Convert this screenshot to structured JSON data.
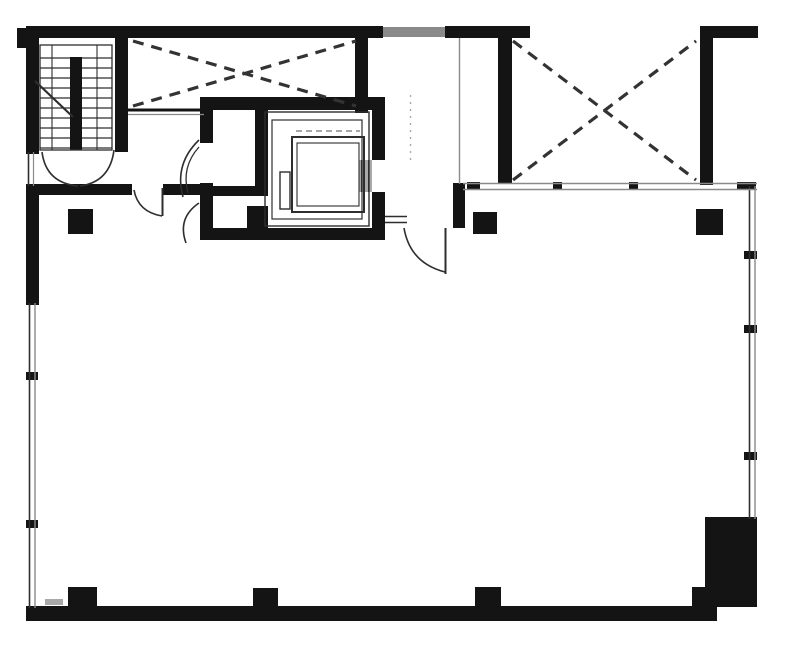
{
  "meta": {
    "description": "Black-and-white architectural floor plan: stairwell top-left, two X-braced shaft bays, central elevator core with cab, open floor area with columns, thin double-line window walls on left and right, heavy corner pier bottom-right"
  },
  "canvas": {
    "w": 787,
    "h": 649,
    "bg": "#ffffff"
  },
  "colors": {
    "wall": "#141414",
    "thin": "#2e2e2e",
    "brace": "#333333",
    "gray": "#8a8a8a",
    "light": "#a9a9a9"
  },
  "plan": {
    "shapes": [
      {
        "kind": "rect",
        "name": "top-wall-left",
        "x": 26,
        "y": 26,
        "w": 357,
        "h": 12,
        "fill": "wall"
      },
      {
        "kind": "rect",
        "name": "top-wall-hatched-segment",
        "x": 383,
        "y": 27,
        "w": 62,
        "h": 10,
        "fill": "gray"
      },
      {
        "kind": "rect",
        "name": "top-wall-right",
        "x": 445,
        "y": 26,
        "w": 85,
        "h": 12,
        "fill": "wall"
      },
      {
        "kind": "rect",
        "name": "top-right-cap-wall",
        "x": 700,
        "y": 26,
        "w": 58,
        "h": 12,
        "fill": "wall"
      },
      {
        "kind": "rect",
        "name": "top-right-side-wall",
        "x": 700,
        "y": 26,
        "w": 13,
        "h": 159,
        "fill": "wall"
      },
      {
        "kind": "rect",
        "name": "right-shaft-left-wall",
        "x": 498,
        "y": 26,
        "w": 14,
        "h": 158,
        "fill": "wall"
      },
      {
        "kind": "rect",
        "name": "stair-left-wall",
        "x": 26,
        "y": 26,
        "w": 13,
        "h": 128,
        "fill": "wall"
      },
      {
        "kind": "rect",
        "name": "top-left-corner-nub",
        "x": 17,
        "y": 28,
        "w": 10,
        "h": 20,
        "fill": "wall"
      },
      {
        "kind": "rect",
        "name": "stair-right-wall",
        "x": 115,
        "y": 26,
        "w": 13,
        "h": 126,
        "fill": "wall"
      },
      {
        "kind": "rect",
        "name": "left-wall-mid",
        "x": 26,
        "y": 184,
        "w": 13,
        "h": 121,
        "fill": "wall"
      },
      {
        "kind": "rect",
        "name": "under-stair-wall",
        "x": 26,
        "y": 184,
        "w": 106,
        "h": 11,
        "fill": "wall"
      },
      {
        "kind": "rect",
        "name": "lobby-wall",
        "x": 163,
        "y": 184,
        "w": 37,
        "h": 11,
        "fill": "wall"
      },
      {
        "kind": "rect",
        "name": "brace-bay-right-wall",
        "x": 355,
        "y": 38,
        "w": 13,
        "h": 75,
        "fill": "wall"
      },
      {
        "kind": "rect",
        "name": "core-top-wall",
        "x": 200,
        "y": 97,
        "w": 185,
        "h": 13,
        "fill": "wall"
      },
      {
        "kind": "rect",
        "name": "core-left-wall-upper",
        "x": 200,
        "y": 97,
        "w": 13,
        "h": 46,
        "fill": "wall"
      },
      {
        "kind": "rect",
        "name": "core-left-wall-lower",
        "x": 200,
        "y": 183,
        "w": 13,
        "h": 57,
        "fill": "wall"
      },
      {
        "kind": "rect",
        "name": "core-right-wall-upper",
        "x": 372,
        "y": 97,
        "w": 13,
        "h": 63,
        "fill": "wall"
      },
      {
        "kind": "rect",
        "name": "core-right-wall-lower",
        "x": 372,
        "y": 192,
        "w": 13,
        "h": 48,
        "fill": "wall"
      },
      {
        "kind": "rect",
        "name": "core-bottom-wall",
        "x": 200,
        "y": 228,
        "w": 185,
        "h": 12,
        "fill": "wall"
      },
      {
        "kind": "rect",
        "name": "core-divider-wall",
        "x": 255,
        "y": 110,
        "w": 13,
        "h": 85,
        "fill": "wall"
      },
      {
        "kind": "rect",
        "name": "core-room-wall",
        "x": 200,
        "y": 186,
        "w": 68,
        "h": 10,
        "fill": "wall"
      },
      {
        "kind": "rect",
        "name": "duct-block",
        "x": 247,
        "y": 206,
        "w": 21,
        "h": 24,
        "fill": "wall"
      },
      {
        "kind": "rect",
        "name": "lobby-stub-wall",
        "x": 453,
        "y": 183,
        "w": 12,
        "h": 45,
        "fill": "wall"
      },
      {
        "kind": "rect",
        "name": "bottom-wall",
        "x": 26,
        "y": 606,
        "w": 691,
        "h": 15,
        "fill": "wall"
      },
      {
        "kind": "rect",
        "name": "corner-pier",
        "x": 705,
        "y": 517,
        "w": 52,
        "h": 90,
        "fill": "wall"
      },
      {
        "kind": "rect",
        "name": "corner-pier-step",
        "x": 692,
        "y": 587,
        "w": 16,
        "h": 33,
        "fill": "wall"
      },
      {
        "kind": "rect",
        "name": "stair-divider-wall",
        "x": 70,
        "y": 57,
        "w": 12,
        "h": 93,
        "fill": "wall"
      },
      {
        "kind": "rect",
        "name": "column-top-left",
        "x": 68,
        "y": 209,
        "w": 25,
        "h": 25,
        "fill": "wall"
      },
      {
        "kind": "rect",
        "name": "column-top-center",
        "x": 473,
        "y": 212,
        "w": 24,
        "h": 22,
        "fill": "wall"
      },
      {
        "kind": "rect",
        "name": "column-top-right",
        "x": 696,
        "y": 209,
        "w": 27,
        "h": 26,
        "fill": "wall"
      },
      {
        "kind": "rect",
        "name": "column-bottom-left",
        "x": 68,
        "y": 587,
        "w": 29,
        "h": 25,
        "fill": "wall"
      },
      {
        "kind": "rect",
        "name": "column-bottom-center-left",
        "x": 253,
        "y": 588,
        "w": 25,
        "h": 25,
        "fill": "wall"
      },
      {
        "kind": "rect",
        "name": "column-bottom-center-right",
        "x": 475,
        "y": 587,
        "w": 26,
        "h": 25,
        "fill": "wall"
      },
      {
        "kind": "rect",
        "name": "spandrel-tick-1",
        "x": 467,
        "y": 182,
        "w": 13,
        "h": 8,
        "fill": "wall"
      },
      {
        "kind": "rect",
        "name": "spandrel-tick-2",
        "x": 553,
        "y": 182,
        "w": 9,
        "h": 8,
        "fill": "wall"
      },
      {
        "kind": "rect",
        "name": "spandrel-tick-3",
        "x": 629,
        "y": 182,
        "w": 9,
        "h": 8,
        "fill": "wall"
      },
      {
        "kind": "rect",
        "name": "spandrel-tick-4",
        "x": 737,
        "y": 182,
        "w": 19,
        "h": 8,
        "fill": "wall"
      },
      {
        "kind": "rect",
        "name": "left-window-mullion-1",
        "x": 26,
        "y": 372,
        "w": 12,
        "h": 8,
        "fill": "wall"
      },
      {
        "kind": "rect",
        "name": "left-window-mullion-2",
        "x": 26,
        "y": 520,
        "w": 12,
        "h": 8,
        "fill": "wall"
      },
      {
        "kind": "rect",
        "name": "right-window-mullion-1",
        "x": 744,
        "y": 251,
        "w": 13,
        "h": 8,
        "fill": "wall"
      },
      {
        "kind": "rect",
        "name": "right-window-mullion-2",
        "x": 744,
        "y": 325,
        "w": 13,
        "h": 8,
        "fill": "wall"
      },
      {
        "kind": "rect",
        "name": "right-window-mullion-3",
        "x": 744,
        "y": 452,
        "w": 13,
        "h": 8,
        "fill": "wall"
      },
      {
        "kind": "rect",
        "name": "corner-sill-dash",
        "x": 45,
        "y": 599,
        "w": 18,
        "h": 6,
        "fill": "light"
      },
      {
        "kind": "rect",
        "name": "elevator-door-panel",
        "x": 359,
        "y": 160,
        "w": 13,
        "h": 32,
        "fill": "light"
      },
      {
        "kind": "rect",
        "name": "elevator-shaft-lining-outer",
        "x": 265,
        "y": 112,
        "w": 104,
        "h": 114,
        "stroke": "thin",
        "sw": 1.4
      },
      {
        "kind": "rect",
        "name": "elevator-shaft-lining-inner",
        "x": 272,
        "y": 120,
        "w": 90,
        "h": 99,
        "stroke": "thin",
        "sw": 1.2
      },
      {
        "kind": "rect",
        "name": "elevator-cab-outer",
        "x": 292,
        "y": 137,
        "w": 72,
        "h": 75,
        "stroke": "thin",
        "sw": 2
      },
      {
        "kind": "rect",
        "name": "elevator-cab-inner",
        "x": 297,
        "y": 143,
        "w": 62,
        "h": 63,
        "stroke": "thin",
        "sw": 1.1
      },
      {
        "kind": "rect",
        "name": "elevator-counterweight",
        "x": 280,
        "y": 172,
        "w": 10,
        "h": 37,
        "stroke": "thin",
        "sw": 1.4
      },
      {
        "kind": "rect",
        "name": "stair-well-frame",
        "x": 40,
        "y": 45,
        "w": 72,
        "h": 105,
        "stroke": "thin",
        "sw": 1.3
      },
      {
        "kind": "line",
        "name": "left-window-line-outer",
        "x1": 29.5,
        "y1": 303,
        "x2": 29.5,
        "y2": 608,
        "stroke": "thin",
        "sw": 1.6
      },
      {
        "kind": "line",
        "name": "left-window-line-inner",
        "x1": 35,
        "y1": 303,
        "x2": 35,
        "y2": 608,
        "stroke": "gray",
        "sw": 1.4
      },
      {
        "kind": "line",
        "name": "stair-window-line-outer",
        "x1": 28.5,
        "y1": 152,
        "x2": 28.5,
        "y2": 186,
        "stroke": "thin",
        "sw": 1.6
      },
      {
        "kind": "line",
        "name": "stair-window-line-inner",
        "x1": 33.5,
        "y1": 152,
        "x2": 33.5,
        "y2": 186,
        "stroke": "gray",
        "sw": 1.2
      },
      {
        "kind": "line",
        "name": "right-window-line-outer",
        "x1": 749.5,
        "y1": 186,
        "x2": 749.5,
        "y2": 519,
        "stroke": "thin",
        "sw": 1.6
      },
      {
        "kind": "line",
        "name": "right-window-line-inner",
        "x1": 755,
        "y1": 186,
        "x2": 755,
        "y2": 519,
        "stroke": "gray",
        "sw": 1.4
      },
      {
        "kind": "line",
        "name": "front-spandrel-line-top",
        "x1": 463,
        "y1": 183.5,
        "x2": 757,
        "y2": 183.5,
        "stroke": "gray",
        "sw": 1.6
      },
      {
        "kind": "line",
        "name": "front-spandrel-line-bottom",
        "x1": 463,
        "y1": 189.5,
        "x2": 757,
        "y2": 189.5,
        "stroke": "gray",
        "sw": 1.6
      },
      {
        "kind": "line",
        "name": "brace-bay-chord",
        "x1": 128,
        "y1": 110,
        "x2": 204,
        "y2": 110,
        "stroke": "wall",
        "sw": 3
      },
      {
        "kind": "line",
        "name": "brace-bay-chord-shadow",
        "x1": 128,
        "y1": 114.5,
        "x2": 204,
        "y2": 114.5,
        "stroke": "gray",
        "sw": 1.2
      },
      {
        "kind": "line",
        "name": "corridor-partition-line",
        "x1": 459.5,
        "y1": 38,
        "x2": 459.5,
        "y2": 184,
        "stroke": "gray",
        "sw": 1.4
      },
      {
        "kind": "line",
        "name": "layout-dotted-line",
        "x1": 410.5,
        "y1": 95,
        "x2": 410.5,
        "y2": 165,
        "stroke": "light",
        "sw": 1.4,
        "dash": "2 5"
      },
      {
        "kind": "line",
        "name": "core-room-finish-line-top",
        "x1": 385,
        "y1": 216.5,
        "x2": 407,
        "y2": 216.5,
        "stroke": "thin",
        "sw": 1.6
      },
      {
        "kind": "line",
        "name": "core-room-finish-line-bottom",
        "x1": 385,
        "y1": 222.5,
        "x2": 407,
        "y2": 222.5,
        "stroke": "thin",
        "sw": 1.6
      },
      {
        "kind": "line",
        "name": "room-door-leaf",
        "x1": 445.5,
        "y1": 228,
        "x2": 445.5,
        "y2": 274,
        "stroke": "thin",
        "sw": 2
      },
      {
        "kind": "line",
        "name": "lobby-door-leaf",
        "x1": 162.5,
        "y1": 188,
        "x2": 162.5,
        "y2": 216,
        "stroke": "thin",
        "sw": 2
      },
      {
        "kind": "line",
        "name": "elevator-door-track-1",
        "x1": 361.5,
        "y1": 160,
        "x2": 361.5,
        "y2": 192,
        "stroke": "thin",
        "sw": 1
      },
      {
        "kind": "line",
        "name": "elevator-door-track-2",
        "x1": 368.5,
        "y1": 160,
        "x2": 368.5,
        "y2": 192,
        "stroke": "thin",
        "sw": 1
      },
      {
        "kind": "line",
        "name": "cab-hatch-line",
        "x1": 296,
        "y1": 131,
        "x2": 360,
        "y2": 131,
        "stroke": "gray",
        "sw": 1.4,
        "dash": "6 4"
      },
      {
        "kind": "line",
        "name": "stair-rail-line-left",
        "x1": 52,
        "y1": 45,
        "x2": 52,
        "y2": 150,
        "stroke": "thin",
        "sw": 1.1
      },
      {
        "kind": "line",
        "name": "stair-rail-line-right",
        "x1": 97,
        "y1": 45,
        "x2": 97,
        "y2": 150,
        "stroke": "thin",
        "sw": 1.1
      },
      {
        "kind": "line",
        "name": "stair-direction-line",
        "x1": 35,
        "y1": 81,
        "x2": 73,
        "y2": 117,
        "stroke": "thin",
        "sw": 2.2
      },
      {
        "kind": "line",
        "name": "stair-tread",
        "x1": 40,
        "y1": 58,
        "x2": 70,
        "y2": 58,
        "stroke": "thin",
        "sw": 1.3
      },
      {
        "kind": "line",
        "name": "stair-tread",
        "x1": 40,
        "y1": 68,
        "x2": 70,
        "y2": 68,
        "stroke": "thin",
        "sw": 1.3
      },
      {
        "kind": "line",
        "name": "stair-tread",
        "x1": 40,
        "y1": 78,
        "x2": 70,
        "y2": 78,
        "stroke": "thin",
        "sw": 1.3
      },
      {
        "kind": "line",
        "name": "stair-tread",
        "x1": 40,
        "y1": 88,
        "x2": 70,
        "y2": 88,
        "stroke": "thin",
        "sw": 1.3
      },
      {
        "kind": "line",
        "name": "stair-tread",
        "x1": 40,
        "y1": 98,
        "x2": 70,
        "y2": 98,
        "stroke": "thin",
        "sw": 1.3
      },
      {
        "kind": "line",
        "name": "stair-tread",
        "x1": 40,
        "y1": 108,
        "x2": 70,
        "y2": 108,
        "stroke": "thin",
        "sw": 1.3
      },
      {
        "kind": "line",
        "name": "stair-tread",
        "x1": 40,
        "y1": 118,
        "x2": 70,
        "y2": 118,
        "stroke": "thin",
        "sw": 1.3
      },
      {
        "kind": "line",
        "name": "stair-tread",
        "x1": 40,
        "y1": 128,
        "x2": 70,
        "y2": 128,
        "stroke": "thin",
        "sw": 1.3
      },
      {
        "kind": "line",
        "name": "stair-tread",
        "x1": 40,
        "y1": 138,
        "x2": 70,
        "y2": 138,
        "stroke": "thin",
        "sw": 1.3
      },
      {
        "kind": "line",
        "name": "stair-tread",
        "x1": 40,
        "y1": 148,
        "x2": 70,
        "y2": 148,
        "stroke": "thin",
        "sw": 1.3
      },
      {
        "kind": "line",
        "name": "stair-tread",
        "x1": 82,
        "y1": 58,
        "x2": 112,
        "y2": 58,
        "stroke": "thin",
        "sw": 1.3
      },
      {
        "kind": "line",
        "name": "stair-tread",
        "x1": 82,
        "y1": 68,
        "x2": 112,
        "y2": 68,
        "stroke": "thin",
        "sw": 1.3
      },
      {
        "kind": "line",
        "name": "stair-tread",
        "x1": 82,
        "y1": 78,
        "x2": 112,
        "y2": 78,
        "stroke": "thin",
        "sw": 1.3
      },
      {
        "kind": "line",
        "name": "stair-tread",
        "x1": 82,
        "y1": 88,
        "x2": 112,
        "y2": 88,
        "stroke": "thin",
        "sw": 1.3
      },
      {
        "kind": "line",
        "name": "stair-tread",
        "x1": 82,
        "y1": 98,
        "x2": 112,
        "y2": 98,
        "stroke": "thin",
        "sw": 1.3
      },
      {
        "kind": "line",
        "name": "stair-tread",
        "x1": 82,
        "y1": 108,
        "x2": 112,
        "y2": 108,
        "stroke": "thin",
        "sw": 1.3
      },
      {
        "kind": "line",
        "name": "stair-tread",
        "x1": 82,
        "y1": 118,
        "x2": 112,
        "y2": 118,
        "stroke": "thin",
        "sw": 1.3
      },
      {
        "kind": "line",
        "name": "stair-tread",
        "x1": 82,
        "y1": 128,
        "x2": 112,
        "y2": 128,
        "stroke": "thin",
        "sw": 1.3
      },
      {
        "kind": "line",
        "name": "stair-tread",
        "x1": 82,
        "y1": 138,
        "x2": 112,
        "y2": 138,
        "stroke": "thin",
        "sw": 1.3
      },
      {
        "kind": "line",
        "name": "stair-tread",
        "x1": 82,
        "y1": 148,
        "x2": 112,
        "y2": 148,
        "stroke": "thin",
        "sw": 1.3
      },
      {
        "kind": "line",
        "name": "x-brace-left-1",
        "x1": 133,
        "y1": 41,
        "x2": 356,
        "y2": 106,
        "stroke": "brace",
        "sw": 3.2,
        "dash": "11 8"
      },
      {
        "kind": "line",
        "name": "x-brace-left-2",
        "x1": 133,
        "y1": 106,
        "x2": 356,
        "y2": 41,
        "stroke": "brace",
        "sw": 3.2,
        "dash": "11 8"
      },
      {
        "kind": "line",
        "name": "x-brace-right-1",
        "x1": 513,
        "y1": 41,
        "x2": 696,
        "y2": 180,
        "stroke": "brace",
        "sw": 3.2,
        "dash": "11 8"
      },
      {
        "kind": "line",
        "name": "x-brace-right-2",
        "x1": 513,
        "y1": 180,
        "x2": 696,
        "y2": 41,
        "stroke": "brace",
        "sw": 3.2,
        "dash": "11 8"
      },
      {
        "kind": "path",
        "name": "stair-lobby-door-arc-left",
        "d": "M 42 152 Q 46 183 78 186",
        "stroke": "thin",
        "sw": 1.6
      },
      {
        "kind": "path",
        "name": "stair-lobby-door-arc-right",
        "d": "M 114 150 Q 110 182 80 186",
        "stroke": "thin",
        "sw": 1.6
      },
      {
        "kind": "path",
        "name": "lobby-door-arc",
        "d": "M 134 190 Q 138 212 162 216",
        "stroke": "thin",
        "sw": 1.6
      },
      {
        "kind": "path",
        "name": "core-door-arc-a",
        "d": "M 199 140 Q 174 164 183 197",
        "stroke": "thin",
        "sw": 1.6
      },
      {
        "kind": "path",
        "name": "core-door-arc-b",
        "d": "M 199 147 Q 181 167 188 193",
        "stroke": "thin",
        "sw": 1.3
      },
      {
        "kind": "path",
        "name": "core-lower-door-arc",
        "d": "M 199 203 Q 177 218 186 243",
        "stroke": "thin",
        "sw": 1.6
      },
      {
        "kind": "path",
        "name": "room-door-arc",
        "d": "M 404 228 Q 410 263 445 272",
        "stroke": "thin",
        "sw": 1.6
      }
    ]
  }
}
